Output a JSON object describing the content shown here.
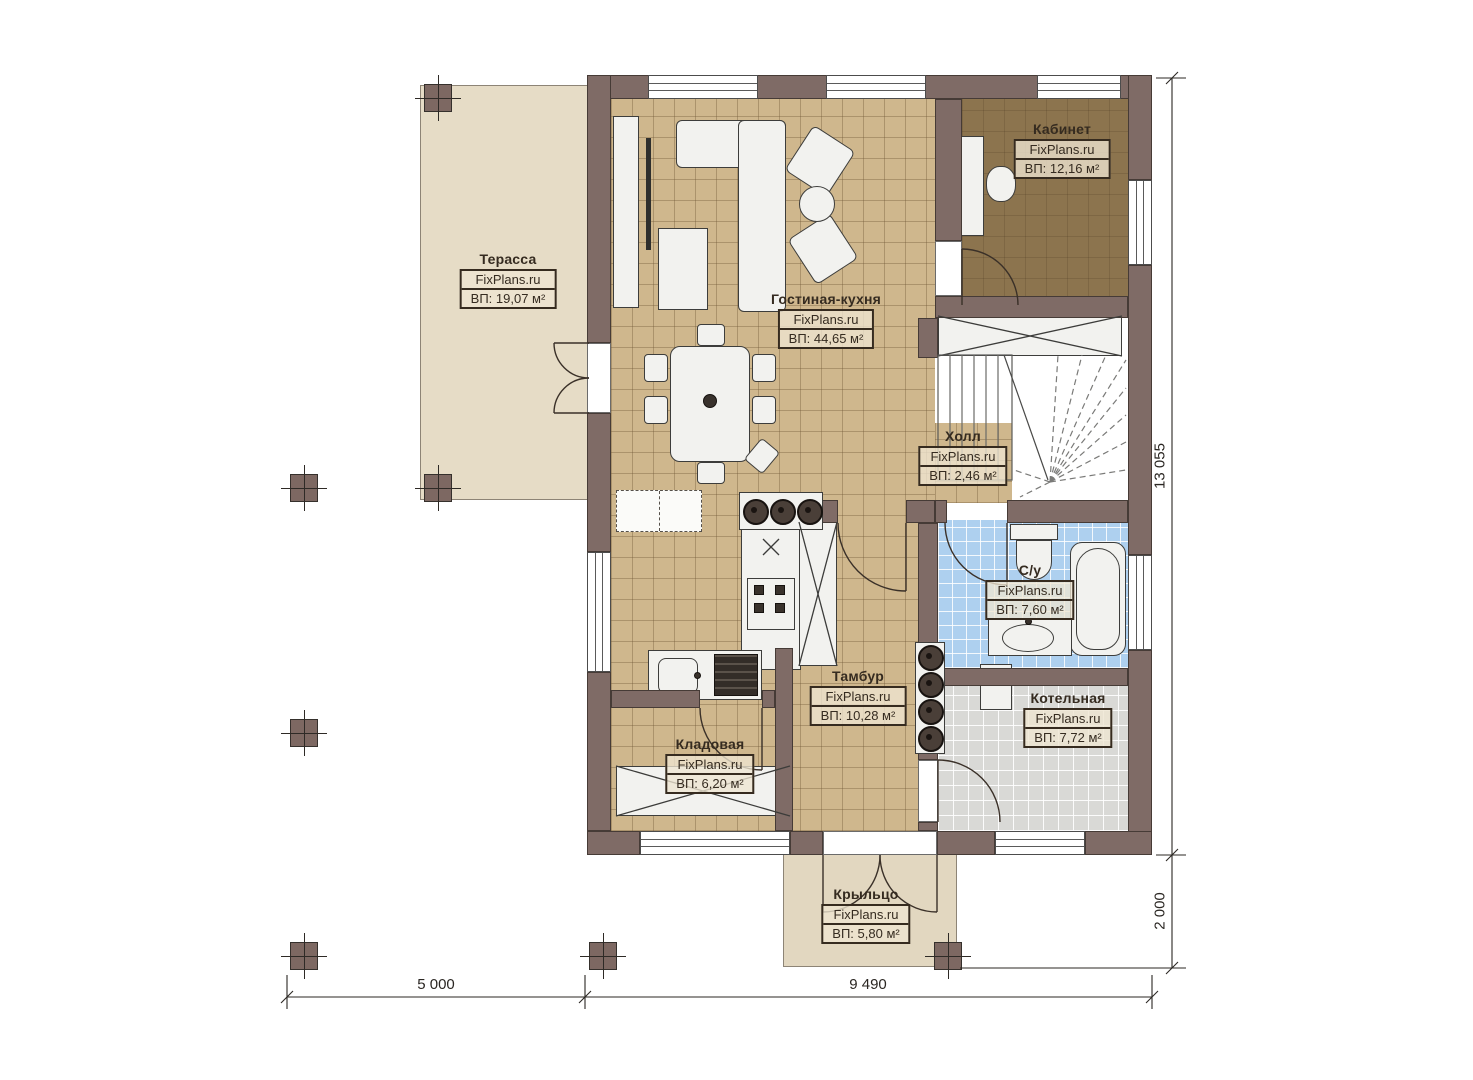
{
  "brand": "FixPlans.ru",
  "rooms": [
    {
      "key": "terrace",
      "name": "Терасса",
      "brand": "FixPlans.ru",
      "area": "ВП: 19,07 м²"
    },
    {
      "key": "office",
      "name": "Кабинет",
      "brand": "FixPlans.ru",
      "area": "ВП: 12,16 м²"
    },
    {
      "key": "living",
      "name": "Гостиная-кухня",
      "brand": "FixPlans.ru",
      "area": "ВП: 44,65 м²"
    },
    {
      "key": "hall",
      "name": "Холл",
      "brand": "FixPlans.ru",
      "area": "ВП: 2,46 м²"
    },
    {
      "key": "bathroom",
      "name": "С/у",
      "brand": "FixPlans.ru",
      "area": "ВП: 7,60 м²"
    },
    {
      "key": "vestibule",
      "name": "Тамбур",
      "brand": "FixPlans.ru",
      "area": "ВП: 10,28 м²"
    },
    {
      "key": "boiler",
      "name": "Котельная",
      "brand": "FixPlans.ru",
      "area": "ВП: 7,72 м²"
    },
    {
      "key": "storage",
      "name": "Кладовая",
      "brand": "FixPlans.ru",
      "area": "ВП: 6,20 м²"
    },
    {
      "key": "porch",
      "name": "Крыльцо",
      "brand": "FixPlans.ru",
      "area": "ВП: 5,80 м²"
    }
  ],
  "dimensions": {
    "total_height": "13 055",
    "porch_offset": "2 000",
    "left_span": "5 000",
    "right_span": "9 490"
  },
  "colors": {
    "wall": "#7f6b66",
    "floor_main": "#cfb78d",
    "floor_office": "#8c744e",
    "floor_bath": "#aed0ef",
    "floor_boiler": "#d9d9d6",
    "floor_terrace": "#e6dcc6"
  }
}
